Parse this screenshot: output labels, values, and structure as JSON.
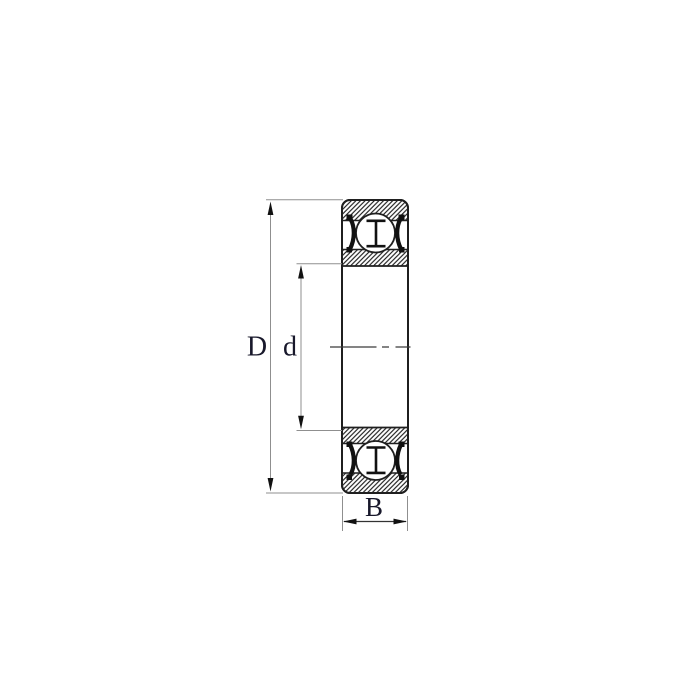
{
  "figure": {
    "type": "bearing-cross-section-drawing",
    "labels": {
      "outer_diameter": "D",
      "bore_diameter": "d",
      "width": "B"
    }
  },
  "colors": {
    "background": "#ffffff",
    "drawing_line": "#1f1f1f",
    "dimension_line": "#8f8f8f",
    "arrow": "#111111",
    "label_text": "#18182b"
  }
}
